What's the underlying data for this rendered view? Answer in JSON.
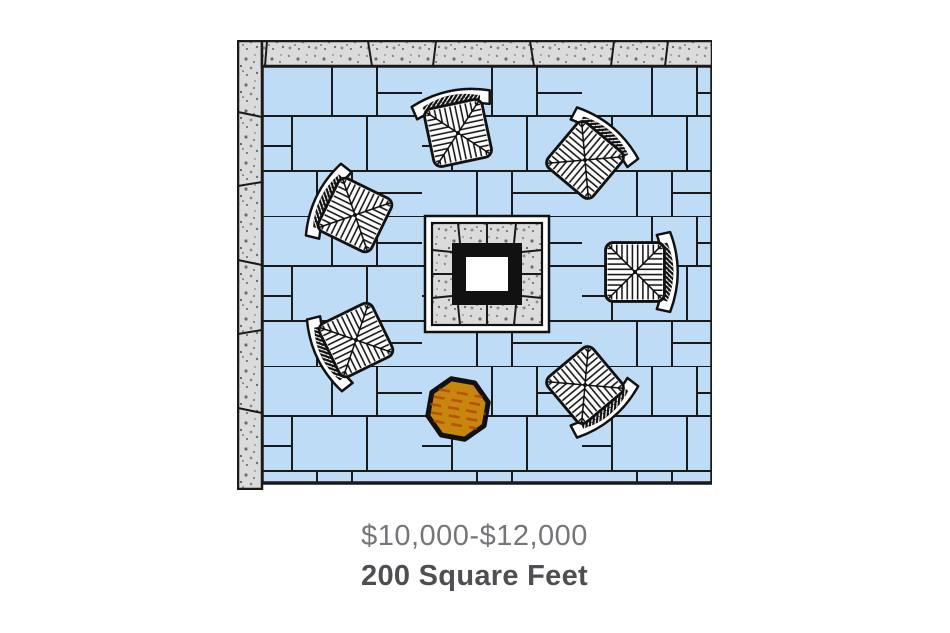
{
  "caption": {
    "price_range": "$10,000-$12,000",
    "area": "200 Square Feet"
  },
  "scene": {
    "title": "patio-floor-plan",
    "elements": [
      "concrete-wall-top",
      "concrete-wall-left",
      "flagstone-paver-patio",
      "square-fire-pit",
      "wicker-chairs",
      "octagonal-side-table"
    ],
    "chair_count": 6,
    "chairs": [
      {
        "x": 458,
        "y": 133,
        "rotation": -12
      },
      {
        "x": 585,
        "y": 160,
        "rotation": 40
      },
      {
        "x": 635,
        "y": 272,
        "rotation": 90
      },
      {
        "x": 355,
        "y": 215,
        "rotation": -64
      },
      {
        "x": 356,
        "y": 340,
        "rotation": -116
      },
      {
        "x": 585,
        "y": 385,
        "rotation": 140
      }
    ],
    "side_table": {
      "x": 458,
      "y": 409,
      "rotation": 10,
      "shape": "octagon"
    }
  },
  "colors": {
    "paver": "#BFDCF6",
    "outline": "#1A1A1A",
    "wall_base": "#DBDBDB",
    "table_fill": "#C8860D",
    "table_grain": "#B44A00",
    "price_text": "#76767A",
    "area_text": "#4F4F53",
    "background": "#FFFFFF"
  }
}
